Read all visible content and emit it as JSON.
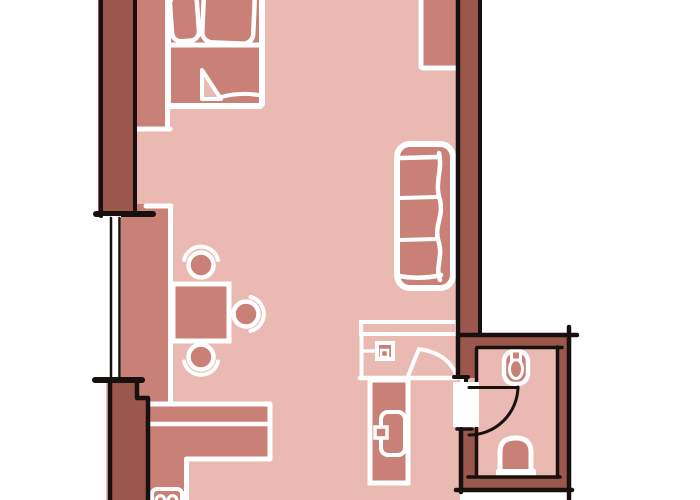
{
  "meta": {
    "type": "floor-plan-sketch",
    "style": "hand-drawn marker sketch, no text labels",
    "canvas": {
      "width": 700,
      "height": 500
    }
  },
  "palette": {
    "background": "#ffffff",
    "floor": "#eab9b1",
    "furniture": "#c98177",
    "wall": "#9c574c",
    "outline": "#17100e",
    "sketch_line": "#ffffff"
  },
  "rooms": [
    {
      "id": "main-room",
      "label": "main living area"
    },
    {
      "id": "bathroom",
      "label": "bathroom"
    }
  ],
  "furniture": [
    "bed-with-two-pillows-and-folded-blanket",
    "nightstand-strip",
    "window-side-counter",
    "dining-table-with-three-chairs",
    "l-shaped-kitchen-counter",
    "stove-two-burners",
    "sofa-three-seats",
    "top-right-wardrobe",
    "entry-partition-with-door",
    "wall-switch-box",
    "tall-cabinet-with-door",
    "toilet",
    "bathroom-sink",
    "bathroom-swing-door",
    "left-wall-window"
  ]
}
